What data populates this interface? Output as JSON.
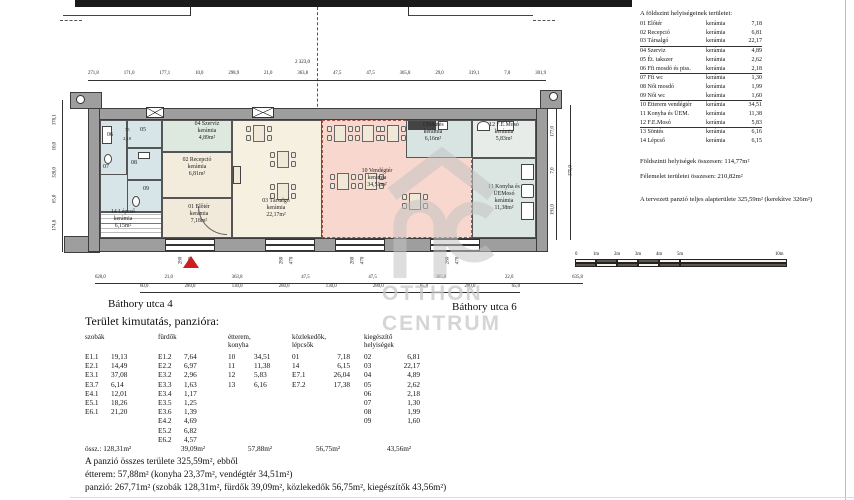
{
  "plan": {
    "room_labels": [
      {
        "id": "eloter",
        "lines": [
          "01 Előtér",
          "kerámia",
          "7,18m²"
        ]
      },
      {
        "id": "recepcio",
        "lines": [
          "02 Recepció",
          "kerámia",
          "6,81m²"
        ]
      },
      {
        "id": "tarsalgo",
        "lines": [
          "03 Társalgó",
          "kerámia",
          "22,17m²"
        ]
      },
      {
        "id": "szerviz",
        "lines": [
          "04 Szerviz",
          "kerámia",
          "4,89m²"
        ]
      },
      {
        "id": "vendegter",
        "lines": [
          "10 Vendégtér",
          "kerámia",
          "34,51m²"
        ]
      },
      {
        "id": "konyha",
        "lines": [
          "11 Konyha és",
          "ÜEMosó",
          "kerámia",
          "11,38m²"
        ]
      },
      {
        "id": "femoso",
        "lines": [
          "12 F.E.Mosó",
          "kerámia",
          "5,83m²"
        ]
      },
      {
        "id": "sontes",
        "lines": [
          "13Söntés",
          "kerámia",
          "6,16m²"
        ]
      },
      {
        "id": "lepcso",
        "lines": [
          "14 Lépcső",
          "kerámia",
          "6,15m²"
        ]
      }
    ],
    "small_room_numbers": [
      "05",
      "06",
      "07",
      "08",
      "09"
    ],
    "door_dim_labels": [
      "75",
      "2,10"
    ],
    "window_dims": [
      "280",
      "470"
    ],
    "streets": {
      "left": "Báthory utca 4",
      "right": "Báthory utca 6"
    },
    "dims": {
      "top_total": "2 323,0",
      "top_row": [
        "271,8",
        "171,0",
        "177,1",
        "10,0",
        "298,9",
        "21,0",
        "363,8",
        "47,5",
        "47,5",
        "365,8",
        "29,0",
        "319,1",
        "7,0",
        "301,9"
      ],
      "bottom_row1": [
        "620,0",
        "21,0",
        "363,8",
        "47,5",
        "47,5",
        "365,8",
        "22,0",
        "635,8"
      ],
      "bottom_row2": [
        "60,0",
        "280,0",
        "130,0",
        "280,0",
        "130,0",
        "280,0",
        "65,0",
        "280,0",
        "65,0"
      ],
      "left_col": [
        "174,8",
        "65,0",
        "328,0",
        "10,0",
        "378,1"
      ],
      "right_col": [
        "191,0",
        "7,0",
        "177,0"
      ],
      "right_col_outer": "375,0"
    }
  },
  "scalebar": {
    "labels": [
      "0",
      "1m",
      "2m",
      "3m",
      "4m",
      "5m",
      "10m"
    ]
  },
  "watermark": {
    "logo": "otthon-centrum-house-logo",
    "line1": "OTTHON",
    "line2": "CENTRUM"
  },
  "legend": {
    "title": "A földszint helyiségeinek területei:",
    "rows": [
      {
        "name": "01 Előtér",
        "material": "kerámia",
        "area": "7,18",
        "underline": false
      },
      {
        "name": "02 Recepció",
        "material": "kerámia",
        "area": "6,81",
        "underline": false
      },
      {
        "name": "03 Társalgó",
        "material": "kerámia",
        "area": "22,17",
        "underline": true
      },
      {
        "name": "04 Szerviz",
        "material": "kerámia",
        "area": "4,89",
        "underline": false
      },
      {
        "name": "05 Ét. takszer",
        "material": "kerámia",
        "area": "2,62",
        "underline": false
      },
      {
        "name": "06 Ffi mosdó és piss.",
        "material": "kerámia",
        "area": "2,18",
        "underline": true
      },
      {
        "name": "07 Ffi wc",
        "material": "kerámia",
        "area": "1,30",
        "underline": false
      },
      {
        "name": "08 Női mosdó",
        "material": "kerámia",
        "area": "1,99",
        "underline": false
      },
      {
        "name": "09 Női wc",
        "material": "kerámia",
        "area": "1,60",
        "underline": true
      },
      {
        "name": "10 Étterem vendégtér",
        "material": "kerámia",
        "area": "34,51",
        "underline": false
      },
      {
        "name": "11 Konyha és ÜEM.",
        "material": "kerámia",
        "area": "11,38",
        "underline": false
      },
      {
        "name": "12 F.E.Mosó",
        "material": "kerámia",
        "area": "5,83",
        "underline": true
      },
      {
        "name": "13 Söntés",
        "material": "kerámia",
        "area": "6,16",
        "underline": false
      },
      {
        "name": "14 Lépcső",
        "material": "kerámia",
        "area": "6,15",
        "underline": false
      }
    ],
    "summary1": "Földszinti helyiségek összesen: 114,77m²",
    "summary2": "Félemelet területei összesen:  210,82m²",
    "summary3": "A tervezett panzió teljes alapterülete 325,59m² (kerekítve 326m²)"
  },
  "area_table": {
    "title": "Terület kimutatás, panzióra:",
    "col_headers": [
      [
        "szobák",
        ""
      ],
      [
        "fürdők",
        ""
      ],
      [
        "étterem,",
        "konyha"
      ],
      [
        "közlekedők,",
        "lépcsők"
      ],
      [
        "kiegészítő",
        "helyiségek"
      ]
    ],
    "rows": [
      [
        [
          "E1.1",
          "19,13"
        ],
        [
          "E1.2",
          "7,64"
        ],
        [
          "10",
          "34,51"
        ],
        [
          "01",
          "7,18"
        ],
        [
          "02",
          "6,81"
        ]
      ],
      [
        [
          "E2.1",
          "14,49"
        ],
        [
          "E2.2",
          "6,97"
        ],
        [
          "11",
          "11,38"
        ],
        [
          "14",
          "6,15"
        ],
        [
          "03",
          "22,17"
        ]
      ],
      [
        [
          "E3.1",
          "37,08"
        ],
        [
          "E3.2",
          "2,96"
        ],
        [
          "12",
          "5,83"
        ],
        [
          "E7.1",
          "26,04"
        ],
        [
          "04",
          "4,89"
        ]
      ],
      [
        [
          "E3.7",
          "6,14"
        ],
        [
          "E3.3",
          "1,63"
        ],
        [
          "13",
          "6,16"
        ],
        [
          "E7.2",
          "17,38"
        ],
        [
          "05",
          "2,62"
        ]
      ],
      [
        [
          "E4.1",
          "12,01"
        ],
        [
          "E3.4",
          "1,17"
        ],
        [
          "",
          ""
        ],
        [
          "",
          ""
        ],
        [
          "06",
          "2,18"
        ]
      ],
      [
        [
          "E5.1",
          "18,26"
        ],
        [
          "E3.5",
          "1,25"
        ],
        [
          "",
          ""
        ],
        [
          "",
          ""
        ],
        [
          "07",
          "1,30"
        ]
      ],
      [
        [
          "E6.1",
          "21,20"
        ],
        [
          "E3.6",
          "1,39"
        ],
        [
          "",
          ""
        ],
        [
          "",
          ""
        ],
        [
          "08",
          "1,99"
        ]
      ],
      [
        [
          "",
          ""
        ],
        [
          "E4.2",
          "4,69"
        ],
        [
          "",
          ""
        ],
        [
          "",
          ""
        ],
        [
          "09",
          "1,60"
        ]
      ],
      [
        [
          "",
          ""
        ],
        [
          "E5.2",
          "6,82"
        ],
        [
          "",
          ""
        ],
        [
          "",
          ""
        ],
        [
          "",
          ""
        ]
      ],
      [
        [
          "",
          ""
        ],
        [
          "E6.2",
          "4,57"
        ],
        [
          "",
          ""
        ],
        [
          "",
          ""
        ],
        [
          "",
          ""
        ]
      ]
    ],
    "total_label": "össz.:",
    "totals": [
      "128,31m²",
      "39,09m²",
      "57,88m²",
      "56,75m²",
      "43,56m²"
    ],
    "footer": [
      "A panzió összes területe 325,59m², ebből",
      "étterem: 57,88m² (konyha 23,37m², vendégtér 34,51m²)",
      "panzió: 267,71m² (szobák 128,31m², fürdők 39,09m², közlekedők 56,75m², kiegészítők 43,56m²)"
    ]
  },
  "colors": {
    "room_beige": "#f4eedd",
    "room_pink": "#f8d7ce",
    "room_blue": "#d7e5e9",
    "room_green": "#dde8df",
    "room_teal": "#d8e4e1",
    "wall_gray": "#9e9e9e",
    "watermark_gray": "#c8c8c8",
    "entrance_red": "#cc2020"
  }
}
